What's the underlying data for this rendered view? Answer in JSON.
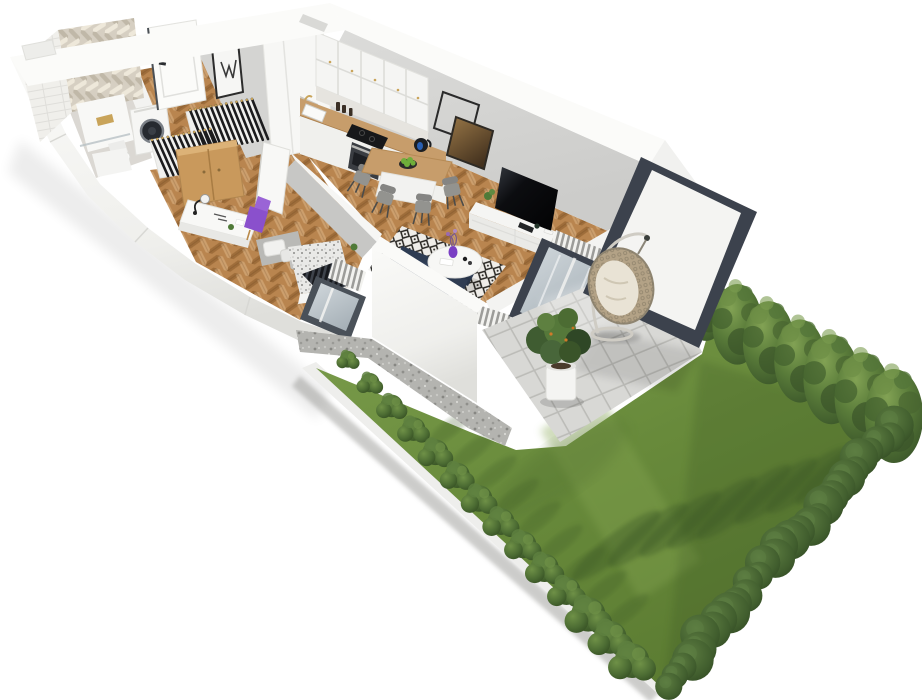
{
  "meta": {
    "description": "Photorealistic 3D isometric rendering of a one-bedroom ground-floor apartment floor plan with a paved terrace and a private hedged garden",
    "image_type": "architectural-3d-floorplan-render",
    "background": "#ffffff"
  },
  "palette": {
    "wall_top": "#fbfbf9",
    "wall_face": "#f1f1ee",
    "wall_shade": "#e2e2de",
    "interior_wall": "#d6d6d4",
    "interior_wall_dark": "#c7c7c5",
    "wood": "#b9854f",
    "counter": "#c79d6b",
    "oak": "#c9995c",
    "bath_tile": "#dbd8d3",
    "chevron": "#d6cfc2",
    "grass": "#698a3c",
    "tile": "#d8d8d5",
    "grout": "#bcbcb8",
    "gravel": "#b4b4b0",
    "curb": "#eeeeec",
    "sofa_navy": "#36455f",
    "accent_purple": "#8a50cc",
    "tv_black": "#0e0f12",
    "frame_dark": "#3c424d",
    "glass": "#bcc5cb",
    "rattan": "#b3a286",
    "cushion": "#e9e3d5",
    "chair_gray": "#93938f",
    "gold": "#c9a45a",
    "radiator": "#f2f2ef"
  },
  "apartment": {
    "rooms": [
      {
        "name": "bathroom",
        "items": [
          "herringbone-feature-tile-wall",
          "white-brick-wall",
          "walk-in-shower",
          "toilet",
          "vanity",
          "washing-machine"
        ]
      },
      {
        "name": "hallway",
        "items": [
          "entrance-door",
          "picture-frame",
          "open-coat-rack-with-hangers",
          "second-coat-rack",
          "tall-white-cabinet"
        ]
      },
      {
        "name": "kitchen",
        "items": [
          "upper-cabinets",
          "marble-backsplash",
          "wood-counter",
          "sink",
          "cooktop",
          "oven",
          "kettle"
        ]
      },
      {
        "name": "dining",
        "items": [
          "wood-top-table",
          "four-gray-chairs",
          "bowl-of-green-apples"
        ]
      },
      {
        "name": "living-room",
        "items": [
          "wall-mounted-tv",
          "white-sideboard",
          "wire-square-frame",
          "bronze-glass-panel",
          "navy-sofa",
          "round-coffee-table",
          "purple-vase",
          "diamond-pattern-rug",
          "radiators",
          "terrace-glass-door"
        ]
      },
      {
        "name": "bedroom",
        "items": [
          "upholstered-bed",
          "patterned-blanket",
          "pillows",
          "white-desk",
          "desk-lamp",
          "purple-chair",
          "oak-wardrobe",
          "glass-door",
          "radiators"
        ]
      }
    ]
  },
  "outdoor": {
    "terrace": {
      "items": [
        "paved-tile-floor",
        "hanging-egg-chair",
        "potted-plant",
        "privacy-screen-panel",
        "gravel-strip"
      ]
    },
    "garden": {
      "lawn": true,
      "perimeter_curb": true,
      "left_bush_count": 14,
      "right_tree_count": 8,
      "back_hedge_segments": 30,
      "tree_shadows_on_lawn": true
    }
  },
  "generated": {
    "bush_row": {
      "from": [
        348,
        358
      ],
      "to": [
        632,
        658
      ],
      "count": 14,
      "scale_from": 0.72,
      "scale_to": 1.35
    },
    "tree_row": {
      "from": [
        706,
        306
      ],
      "to": [
        894,
        416
      ],
      "count": 7,
      "scale_from": 0.88,
      "scale_to": 1.12
    },
    "extra_tree": {
      "x": 668,
      "y": 304,
      "scale": 0.8
    },
    "hedge": {
      "from": [
        893,
        424
      ],
      "to": [
        664,
        682
      ],
      "count": 30,
      "r_base": 13,
      "r_var": 8,
      "jitter": 14
    },
    "finger_shadows": {
      "start": [
        616,
        546
      ],
      "step": [
        32,
        -11
      ],
      "count": 8,
      "rx": 52,
      "ry": 12,
      "rot": -38,
      "opacity": 0.4
    },
    "bush_shadows": {
      "start": [
        420,
        432
      ],
      "step": [
        22,
        23
      ],
      "count": 9,
      "offset": [
        30,
        -4
      ],
      "rx": 28,
      "ry": 8,
      "rot": -38,
      "opacity": 0.26
    },
    "hanger_racks": [
      {
        "top": [
          [
            190,
            110
          ],
          [
            252,
            99
          ]
        ],
        "bottom": [
          [
            202,
            150
          ],
          [
            264,
            139
          ]
        ],
        "count": 13
      },
      {
        "top": [
          [
            152,
            140
          ],
          [
            210,
            129
          ]
        ],
        "bottom": [
          [
            164,
            176
          ],
          [
            222,
            165
          ]
        ],
        "count": 12
      }
    ]
  }
}
